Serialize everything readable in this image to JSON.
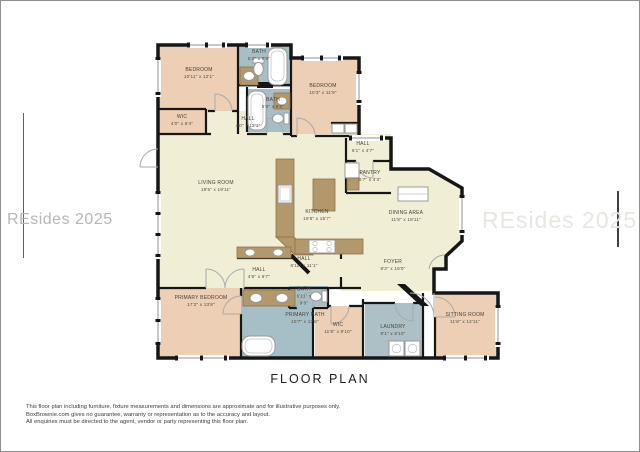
{
  "plan": {
    "title": "FLOOR PLAN",
    "watermarks": {
      "left": "REsides 2025",
      "right": "REsides 2025"
    },
    "rooms": [
      {
        "id": "bedroom-1",
        "name": "BEDROOM",
        "dims": "10'11\" x 12'1\""
      },
      {
        "id": "bath-1",
        "name": "BATH",
        "dims": "5'4\" x 8'5\""
      },
      {
        "id": "bath-2",
        "name": "BATH",
        "dims": "5'3\" x 8'6\""
      },
      {
        "id": "bedroom-2",
        "name": "BEDROOM",
        "dims": "10'3\" x 11'9\""
      },
      {
        "id": "wic-1",
        "name": "WIC",
        "dims": "4'0\" x 6'4\""
      },
      {
        "id": "hall-1",
        "name": "HALL",
        "dims": "4'0\" x 12'1\""
      },
      {
        "id": "living-room",
        "name": "LIVING ROOM",
        "dims": "19'5\" x 19'11\""
      },
      {
        "id": "kitchen",
        "name": "KITCHEN",
        "dims": "19'8\" x 15'7\""
      },
      {
        "id": "hall-2",
        "name": "HALL",
        "dims": "6'1\" x 4'7\""
      },
      {
        "id": "pantry",
        "name": "PANTRY",
        "dims": "5'7\" x 4'3\""
      },
      {
        "id": "dining-area",
        "name": "DINING AREA",
        "dims": "11'8\" x 18'11\""
      },
      {
        "id": "hall-3",
        "name": "HALL",
        "dims": "6'11\" x 11'1\""
      },
      {
        "id": "hall-4",
        "name": "HALL",
        "dims": "4'6\" x 6'7\""
      },
      {
        "id": "foyer",
        "name": "FOYER",
        "dims": "8'3\" x 18'0\""
      },
      {
        "id": "bath-3",
        "name": "BATH",
        "dims": "6'11\" x 9'0\""
      },
      {
        "id": "primary-bedroom",
        "name": "PRIMARY BEDROOM",
        "dims": "17'2\" x 13'8\""
      },
      {
        "id": "primary-bath",
        "name": "PRIMARY BATH",
        "dims": "10'7\" x 12'8\""
      },
      {
        "id": "wic-2",
        "name": "WIC",
        "dims": "11'8\" x 9'10\""
      },
      {
        "id": "laundry",
        "name": "LAUNDRY",
        "dims": "8'1\" x 9'10\""
      },
      {
        "id": "sitting-room",
        "name": "SITTING ROOM",
        "dims": "11'8\" x 12'11\""
      }
    ],
    "disclaimer": [
      "This floor plan including furniture, fixture measurements and dimensions are approximate and for illustrative purposes only.",
      "BoxBrownie.com gives no guarantee, warranty or representation as to the accuracy and layout.",
      "All enquiries must be directed to the agent, vendor or party representing this floor plan."
    ]
  },
  "colors": {
    "peach": "#eccfb4",
    "cream": "#f0efd6",
    "bath": "#a6bfc7",
    "laundry": "#adc0c6",
    "counter": "#b2986a",
    "wall": "#161616"
  }
}
